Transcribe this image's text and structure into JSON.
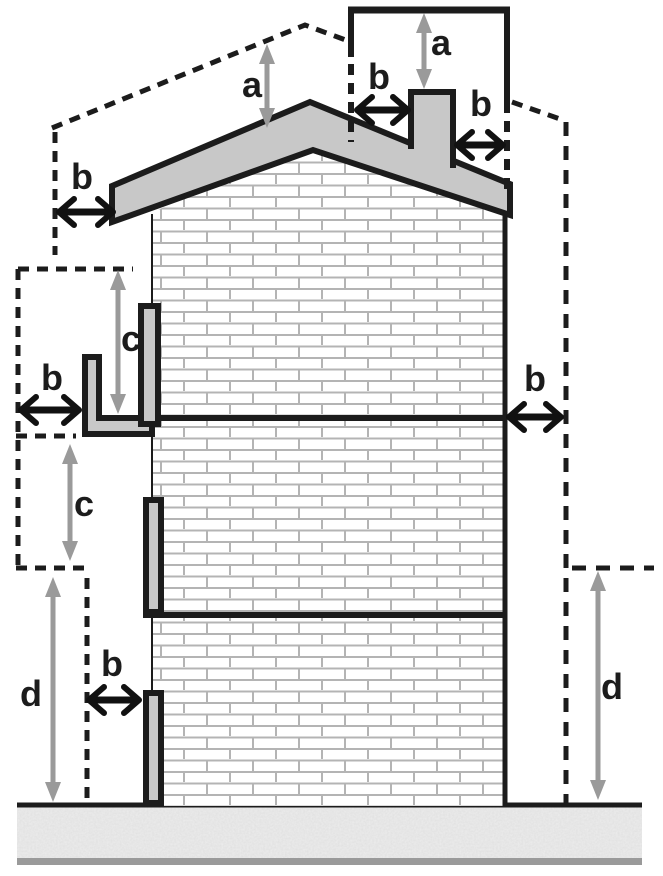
{
  "figure": {
    "type": "technical-diagram",
    "subject": "building elevation with clearance-dimension annotations",
    "dimension_labels": {
      "a": "a",
      "b": "b",
      "c": "c",
      "d": "d"
    },
    "annotations": [
      {
        "id": "a-above-roof-ridge",
        "label": "a"
      },
      {
        "id": "a-above-chimney",
        "label": "a"
      },
      {
        "id": "b-left-of-eave",
        "label": "b"
      },
      {
        "id": "b-left-of-chimney",
        "label": "b"
      },
      {
        "id": "b-right-of-chimney",
        "label": "b"
      },
      {
        "id": "b-right-of-wall",
        "label": "b"
      },
      {
        "id": "b-left-of-balcony",
        "label": "b"
      },
      {
        "id": "b-left-of-ground-shutter",
        "label": "b"
      },
      {
        "id": "c-above-balcony",
        "label": "c"
      },
      {
        "id": "c-below-balcony",
        "label": "c"
      },
      {
        "id": "d-left-ground-clearance",
        "label": "d"
      },
      {
        "id": "d-right-ground-clearance",
        "label": "d"
      }
    ],
    "colors": {
      "structure_fill": "#c8c8c8",
      "outline": "#1c1c1c",
      "measure_arrow": "#9a9a9a",
      "brick_line": "#b4b4b4",
      "ground_fill": "#ededed",
      "ground_speckle": "#8c8c8c",
      "ground_baseline": "#9a9a9a"
    }
  }
}
